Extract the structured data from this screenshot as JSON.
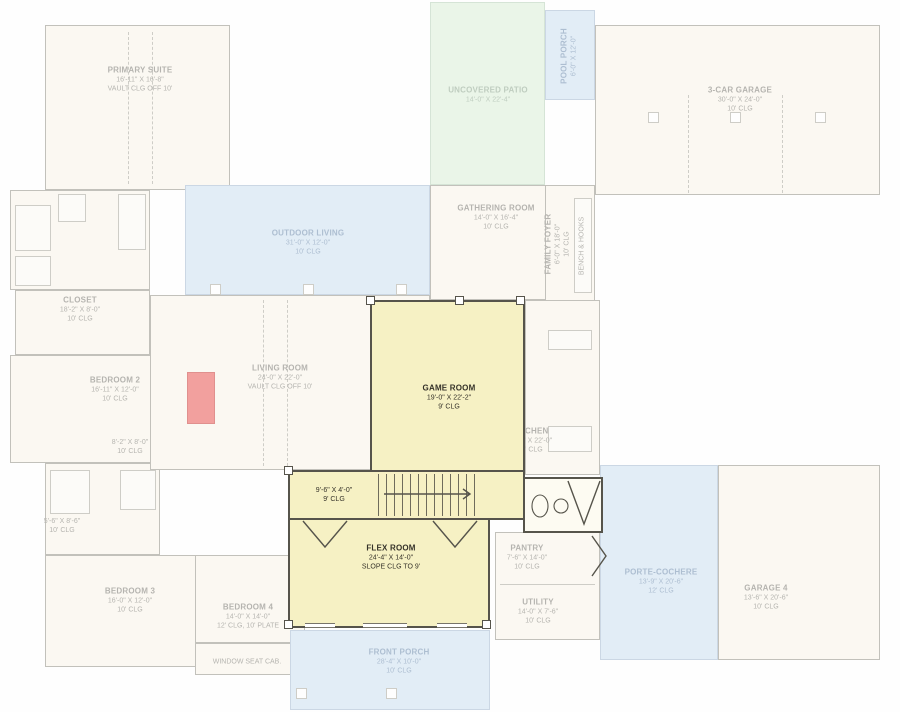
{
  "plan_title": "Floor plan with highlighted game room level",
  "colors": {
    "highlight_fill": "#f6f1c4",
    "highlight_wall": "#56544b",
    "patio_green": "#cfe9cc",
    "porch_blue": "#bcd6ec",
    "fireplace_red": "#f2a09e",
    "faded_line": "#8d8a7c"
  },
  "rooms": {
    "primary_suite": {
      "name": "PRIMARY SUITE",
      "dims": "16'-11\" X 16'-8\"",
      "clg": "VAULT CLG OFF 10'"
    },
    "closet": {
      "name": "CLOSET",
      "dims": "18'-2\" X 8'-0\"",
      "clg": "10' CLG"
    },
    "bedroom_2": {
      "name": "BEDROOM 2",
      "dims": "16'-11\" X 12'-0\"",
      "clg": "10' CLG"
    },
    "nook_1": {
      "dims": "8'-2\" X 8'-0\"",
      "clg": "10' CLG"
    },
    "nook_2": {
      "dims": "5'-6\" X 8'-6\"",
      "clg": "10' CLG"
    },
    "bedroom_3": {
      "name": "BEDROOM 3",
      "dims": "16'-0\" X 12'-0\"",
      "clg": "10' CLG"
    },
    "bedroom_4": {
      "name": "BEDROOM 4",
      "dims": "14'-0\" X 14'-0\"",
      "clg": "12' CLG, 10' PLATE"
    },
    "window_seat": {
      "name": "WINDOW SEAT CAB."
    },
    "outdoor_living": {
      "name": "OUTDOOR LIVING",
      "dims": "31'-0\" X 12'-0\"",
      "clg": "10' CLG"
    },
    "living_room": {
      "name": "LIVING ROOM",
      "dims": "24'-0\" X 22'-0\"",
      "clg": "VAULT CLG OFF 10'"
    },
    "uncovered_patio": {
      "name": "UNCOVERED PATIO",
      "dims": "14'-0\" X 22'-4\""
    },
    "pool_porch": {
      "name": "POOL PORCH",
      "dims": "6'-0\" X 12'-0\""
    },
    "gathering_room": {
      "name": "GATHERING ROOM",
      "dims": "14'-0\" X 16'-4\"",
      "clg": "10' CLG"
    },
    "family_foyer": {
      "name": "FAMILY FOYER",
      "dims": "6'-0\" X 18'-0\"",
      "clg": "10' CLG"
    },
    "bench_hooks": {
      "name": "BENCH & HOOKS"
    },
    "garage_3car": {
      "name": "3-CAR GARAGE",
      "dims": "30'-0\" X 24'-0\"",
      "clg": "10' CLG"
    },
    "kitchen": {
      "name": "KITCHEN",
      "dims": "10'-0\" X 22'-0\"",
      "clg": "10' CLG"
    },
    "pantry": {
      "name": "PANTRY",
      "dims": "7'-6\" X 14'-0\"",
      "clg": "10' CLG"
    },
    "utility": {
      "name": "UTILITY",
      "dims": "14'-0\" X 7'-6\"",
      "clg": "10' CLG"
    },
    "front_porch": {
      "name": "FRONT PORCH",
      "dims": "28'-4\" X 10'-0\"",
      "clg": "10' CLG"
    },
    "porte_cochere": {
      "name": "PORTE-COCHERE",
      "dims": "13'-9\" X 20'-6\"",
      "clg": "12' CLG"
    },
    "garage_4": {
      "name": "GARAGE 4",
      "dims": "13'-6\" X 20'-6\"",
      "clg": "10' CLG"
    },
    "game_room": {
      "name": "GAME ROOM",
      "dims": "19'-0\" X 22'-2\"",
      "clg": "9' CLG"
    },
    "hall": {
      "dims": "9'-6\" X 4'-0\"",
      "clg": "9' CLG"
    },
    "flex_room": {
      "name": "FLEX ROOM",
      "dims": "24'-4\" X 14'-0\"",
      "clg": "SLOPE CLG TO 9'"
    }
  }
}
